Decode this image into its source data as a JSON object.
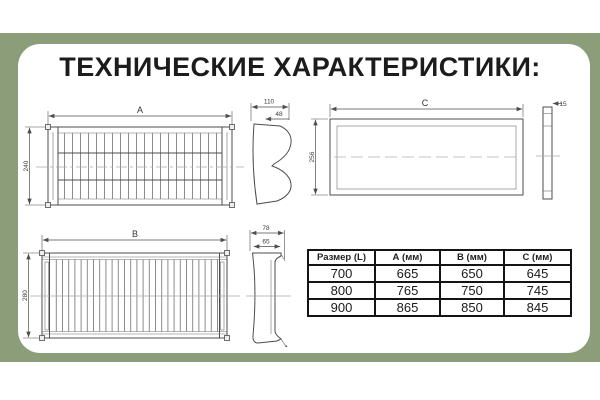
{
  "title": "ТЕХНИЧЕСКИЕ ХАРАКТЕРИСТИКИ:",
  "colors": {
    "background_band": "#8b9e79",
    "card": "#ffffff",
    "drawing_line": "#4d4d4d",
    "table_border": "#141414"
  },
  "drawings": {
    "front_view_a": {
      "width_label": "A",
      "height_label": "240"
    },
    "side_profile_a": {
      "outer_depth_label": "110",
      "inner_depth_label": "48"
    },
    "back_view_c": {
      "width_label": "C",
      "height_label": "256"
    },
    "side_profile_c": {
      "thickness_label": "15"
    },
    "front_view_b": {
      "width_label": "B",
      "height_label": "280"
    },
    "side_profile_b": {
      "outer_depth_label": "78",
      "inner_depth_label": "65"
    }
  },
  "table": {
    "headers": [
      "Размер (L)",
      "А (мм)",
      "В (мм)",
      "С (мм)"
    ],
    "rows": [
      [
        "700",
        "665",
        "650",
        "645"
      ],
      [
        "800",
        "765",
        "750",
        "745"
      ],
      [
        "900",
        "865",
        "850",
        "845"
      ]
    ]
  }
}
